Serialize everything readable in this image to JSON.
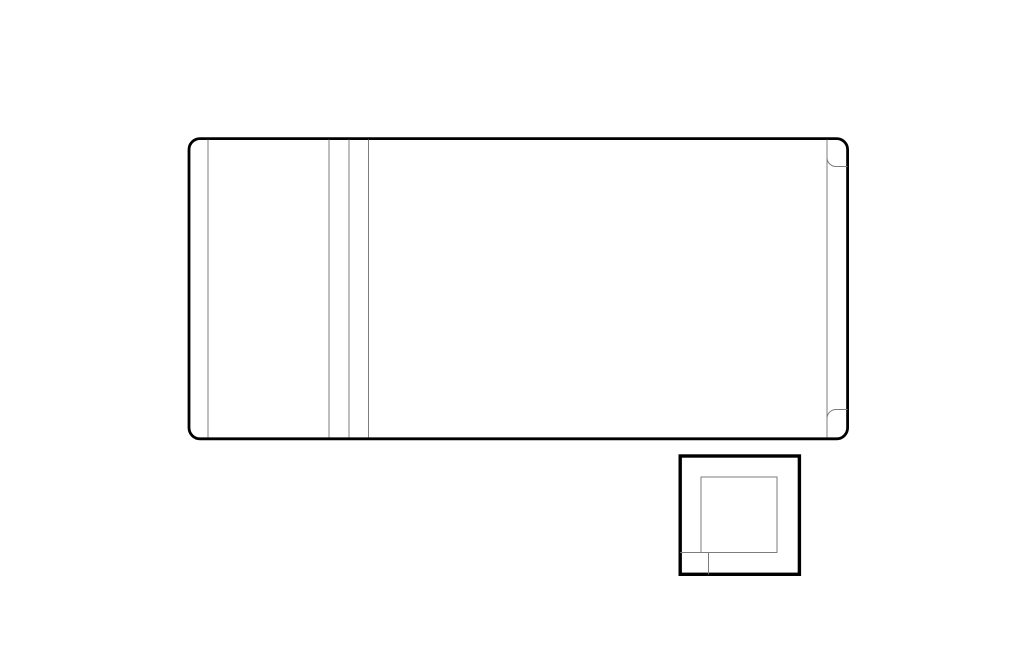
{
  "canvas": {
    "width": 1024,
    "height": 663,
    "background": "#ffffff"
  },
  "palette": {
    "thick_line": "#000000",
    "thin_line": "#7d7d7d",
    "fill": "#ffffff"
  },
  "drawing": {
    "thin_stroke_width": 1,
    "large_panel": {
      "x": 189,
      "y": 138.6,
      "width": 658.6,
      "height": 300.2,
      "corner_radius": 11,
      "stroke_width": 2.8
    },
    "panel_divider_lines": [
      {
        "x": 208,
        "y1": 139.5,
        "y2": 437.5
      },
      {
        "x": 329,
        "y1": 139.5,
        "y2": 437.5
      },
      {
        "x": 349,
        "y1": 139.5,
        "y2": 437.5
      },
      {
        "x": 368.5,
        "y1": 139.5,
        "y2": 437.5
      },
      {
        "x": 827,
        "y1": 139.5,
        "y2": 437.5
      }
    ],
    "right_edge_tabs": [
      {
        "path": "M 847.5 166.5 H 836 A 9 9 0 0 1 827 157.5 V 139.5"
      },
      {
        "path": "M 847.5 409.5 H 836 A 9 9 0 0 0 827 418.5 V 437.5"
      }
    ],
    "small_unit": {
      "outer": {
        "x": 680.2,
        "y": 456,
        "width": 119.2,
        "height": 118.3,
        "stroke_width": 3.4
      },
      "inner": {
        "x": 701,
        "y": 477,
        "width": 76,
        "height": 75.5
      },
      "corner_lines": [
        {
          "x1": 680.2,
          "y1": 552.5,
          "x2": 701,
          "y2": 552.5
        },
        {
          "x1": 708.5,
          "y1": 552.5,
          "x2": 708.5,
          "y2": 574.2
        }
      ]
    }
  }
}
